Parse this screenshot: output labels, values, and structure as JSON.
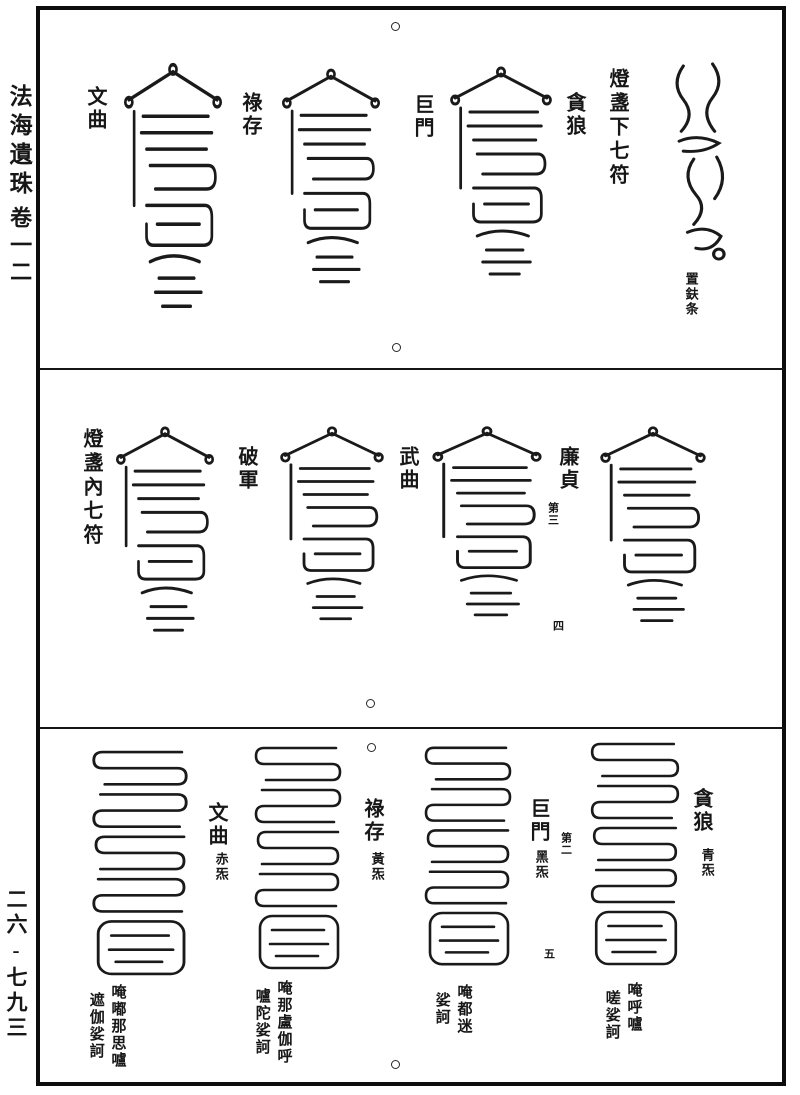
{
  "colors": {
    "ink": "#171717",
    "paper": "#ffffff"
  },
  "margin": {
    "book_title": "法海遺珠",
    "volume_label": "卷一二",
    "page_number": "二六-七九三"
  },
  "top_section": {
    "header": "燈盞下七符",
    "star_labels": [
      "文曲",
      "祿存",
      "巨門",
      "貪狼"
    ],
    "cursive_note": "置鈇条"
  },
  "middle_section": {
    "header": "燈盞內七符",
    "star_labels": [
      "破軍",
      "武曲",
      "廉貞"
    ],
    "order_note": "第三",
    "marker": "四"
  },
  "bottom_section": {
    "marker": "五",
    "talismans": [
      {
        "star": "文曲",
        "color_note": "赤炁",
        "mantra": [
          "唵嘟那思嚧",
          "遮伽娑訶"
        ]
      },
      {
        "star": "祿存",
        "color_note": "黃炁",
        "mantra": [
          "唵那盧伽呼",
          "嚧陀娑訶"
        ]
      },
      {
        "star": "巨門",
        "color_note": "黑炁",
        "order_note": "第二",
        "mantra": [
          "唵都迷",
          "娑訶"
        ]
      },
      {
        "star": "貪狼",
        "color_note": "青炁",
        "mantra": [
          "唵呼嚧",
          "嗟娑訶"
        ]
      }
    ]
  }
}
